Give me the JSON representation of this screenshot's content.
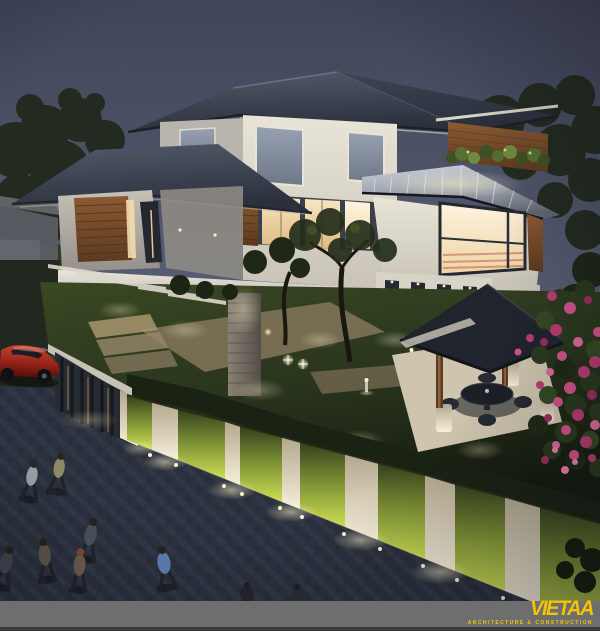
{
  "logo": {
    "name": "VIETAA",
    "tagline": "ARCHITECTURE & CONSTRUCTION"
  },
  "palette": {
    "sky_top": "#41455a",
    "sky_horizon": "#5a6075",
    "roof_slate": "#3e4553",
    "roof_metal": "#9ba1ac",
    "wall_white": "#e8e4d8",
    "wood_cladding": "#8a5a33",
    "window_warm": "#f6e6c2",
    "window_cool": "#97a1b0",
    "lawn_green": "#2a351e",
    "hedge_lit": "#cfdf55",
    "stone_warm": "#b5a383",
    "pavement_blue_gray": "#3a4150",
    "car_red": "#9c241a",
    "flower_pink": "#c9447f",
    "banner_gray": "#6e6e6e",
    "logo_yellow": "#f2c500"
  },
  "scene": {
    "setting": "modern-villa-exterior-render-at-dusk",
    "elements": [
      "hip-roofs",
      "metal-standing-seam-roof",
      "wood-slat-cladding",
      "glowing-windows",
      "roof-edge-planter",
      "stone-feature-column",
      "frangipani-trees",
      "courtyard-uplights",
      "garden-gazebo-with-table",
      "bougainvillea",
      "lit-fence-pillars-and-hedges",
      "entrance-gate",
      "red-car",
      "paved-sidewalk",
      "pedestrians"
    ]
  }
}
